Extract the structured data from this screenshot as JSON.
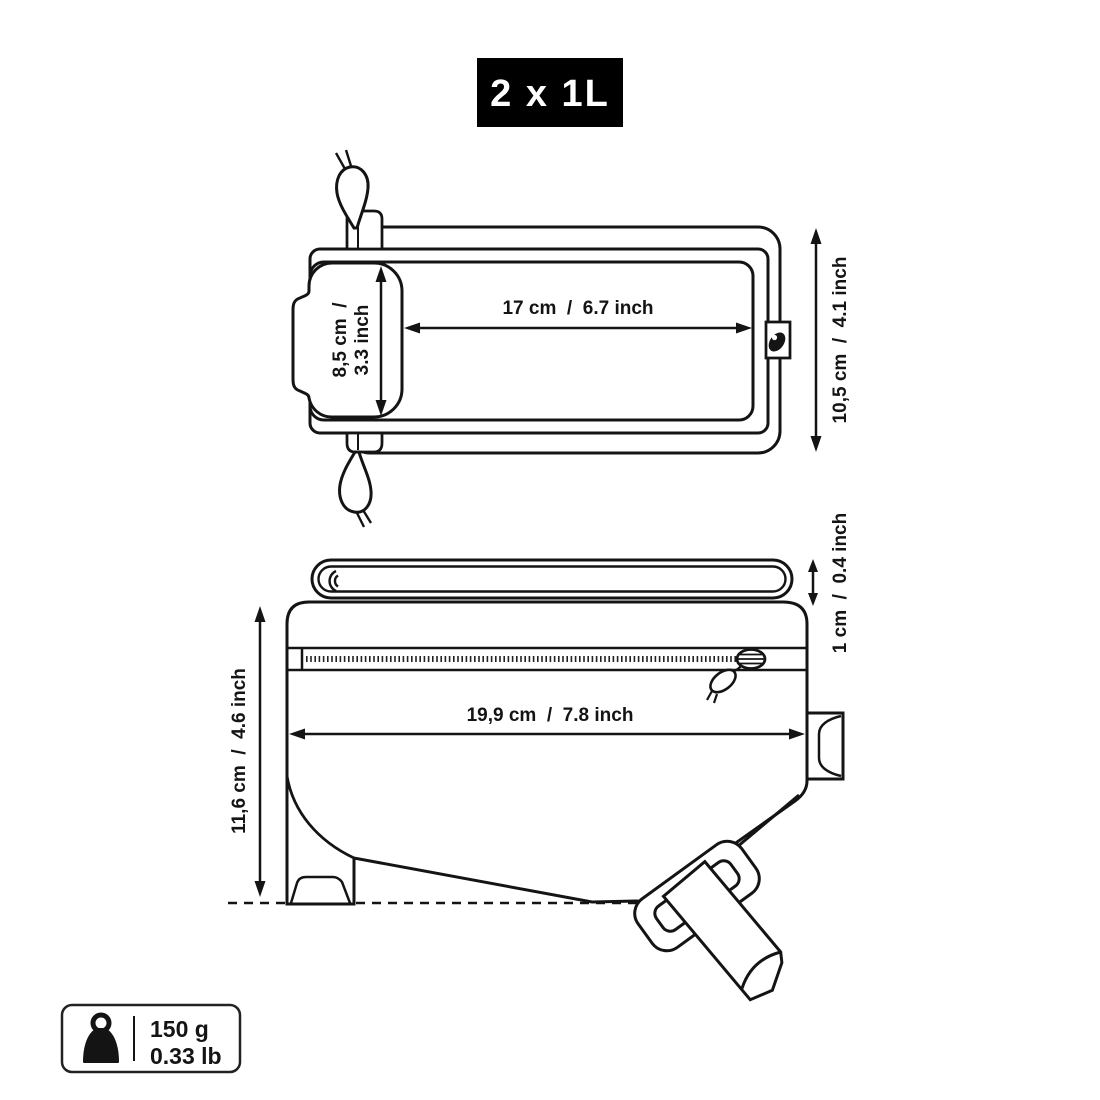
{
  "capacity_badge": {
    "label": "2 x 1L"
  },
  "top_view": {
    "width_label": "17 cm  /  6.7 inch",
    "pocket_height_line1": "8,5 cm  /",
    "pocket_height_line2": "3.3 inch",
    "height_label": "10,5 cm  /  4.1 inch"
  },
  "side_view": {
    "length_label": "19,9 cm  /  7.8 inch",
    "height_label": "11,6 cm  /  4.6 inch",
    "flap_height_label": "1 cm  /  0.4 inch"
  },
  "weight_badge": {
    "metric": "150 g",
    "imperial": "0.33 lb"
  },
  "colors": {
    "line": "#141414",
    "badge_bg": "#000000",
    "badge_text": "#ffffff"
  }
}
